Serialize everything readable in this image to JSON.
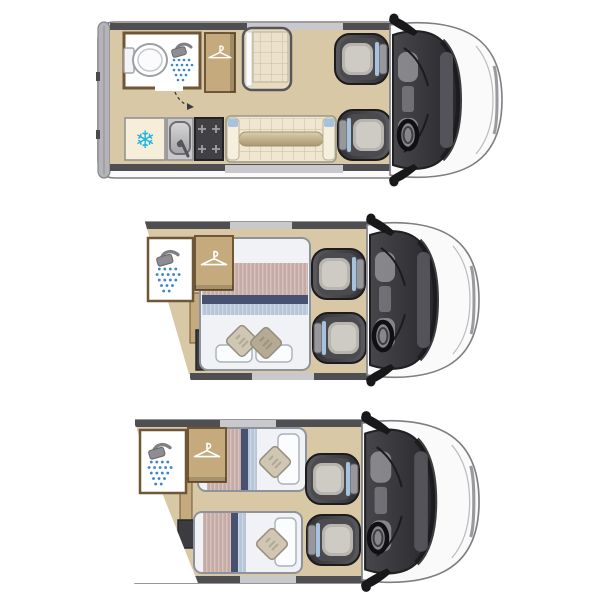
{
  "diagram": {
    "type": "motorhome-floorplan-views",
    "views": [
      {
        "id": "day-lounge-layout",
        "position": "top",
        "features": [
          "rear-doors",
          "bathroom",
          "toilet",
          "shower",
          "wardrobe",
          "travel-seat",
          "fridge",
          "sink",
          "hob",
          "sofa-bench",
          "rear-facing-swivel-seat",
          "driver-seat",
          "steering-wheel",
          "cab"
        ]
      },
      {
        "id": "double-bed-layout",
        "position": "middle",
        "features": [
          "shower",
          "wardrobe",
          "double-bed",
          "blanket",
          "two-square-pillows",
          "two-white-pillows",
          "kitchen-unit",
          "rear-facing-swivel-seat",
          "driver-seat",
          "steering-wheel",
          "cab"
        ]
      },
      {
        "id": "twin-single-beds-layout",
        "position": "bottom",
        "features": [
          "shower",
          "wardrobe",
          "single-bed-top",
          "single-bed-bottom",
          "square-pillows",
          "white-pillows",
          "kitchen-unit",
          "rear-facing-swivel-seat",
          "driver-seat",
          "steering-wheel",
          "cab"
        ]
      }
    ]
  },
  "icons": {
    "snowflake": "❄",
    "shower": "shower-head-with-spray",
    "hanger": "clothes-hanger"
  },
  "colors": {
    "floor": "#d9c8a6",
    "wood": "#c4aa7c",
    "woodDark": "#6f5636",
    "wallDark": "#4f4f53",
    "wallLight": "#c9c9cd",
    "bodyFill": "#fafafa",
    "bodyOutline": "#7e7e82",
    "rearBand": "#b4b4b8",
    "mirrorBlack": "#18181a",
    "seatCushion": "#b7b5ae",
    "accentBlue": "#a5c3de",
    "cushionCream": "#ece2cc",
    "quiltLine": "#c9bc9e",
    "mattress": "#f1f2f5",
    "mattressEdge": "#8d939c",
    "blanketMauve": "#c6aaa5",
    "blanketNavy": "#46526f",
    "blanketBlue": "#b6c5d8",
    "pillowWhite": "#fbfcfe",
    "pillowBeige": "#cfc6b4",
    "pillowTan": "#b5aa93",
    "waterBlue": "#3c86c9",
    "freezerCyan": "#1db4e4",
    "hobDark": "#404045"
  }
}
